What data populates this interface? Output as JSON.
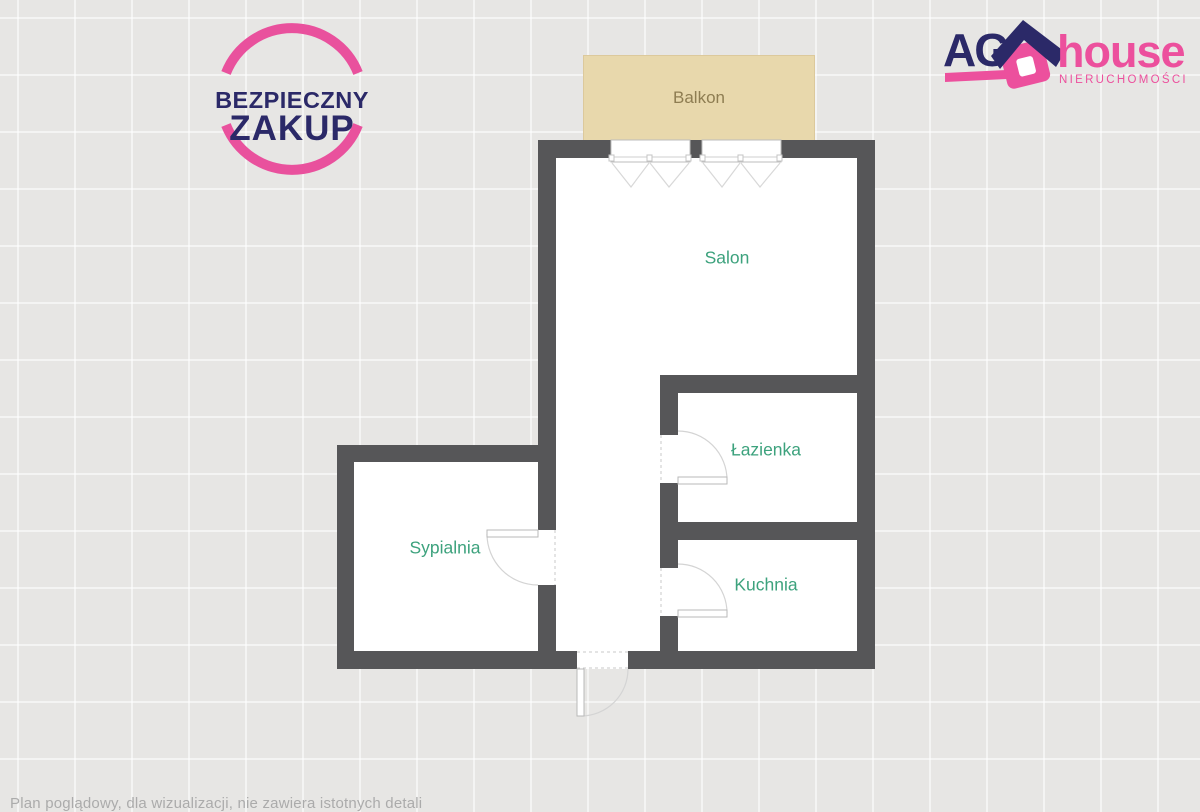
{
  "page": {
    "background": "#e7e6e4",
    "wall_color": "#565658"
  },
  "badges": {
    "bezpieczny_zakup": {
      "line1": "BEZPIECZNY",
      "line2": "ZAKUP",
      "ring_color": "#e9519d",
      "text_color": "#2b2968"
    },
    "agency": {
      "name_bold": "AG",
      "name_accent": "house",
      "subtitle": "NIERUCHOMOŚCI",
      "navy": "#2b2968",
      "pink": "#ec509d"
    }
  },
  "floorplan": {
    "rooms": {
      "balkon": {
        "label": "Balkon",
        "label_color": "#8e7d52",
        "fill": "#e8d8ac"
      },
      "salon": {
        "label": "Salon",
        "label_color": "#3da27d"
      },
      "lazienka": {
        "label": "Łazienka",
        "label_color": "#3da27d"
      },
      "sypialnia": {
        "label": "Sypialnia",
        "label_color": "#3da27d"
      },
      "kuchnia": {
        "label": "Kuchnia",
        "label_color": "#3da27d"
      }
    }
  },
  "footer": {
    "disclaimer": "Plan poglądowy, dla wizualizacji, nie zawiera istotnych detali"
  }
}
